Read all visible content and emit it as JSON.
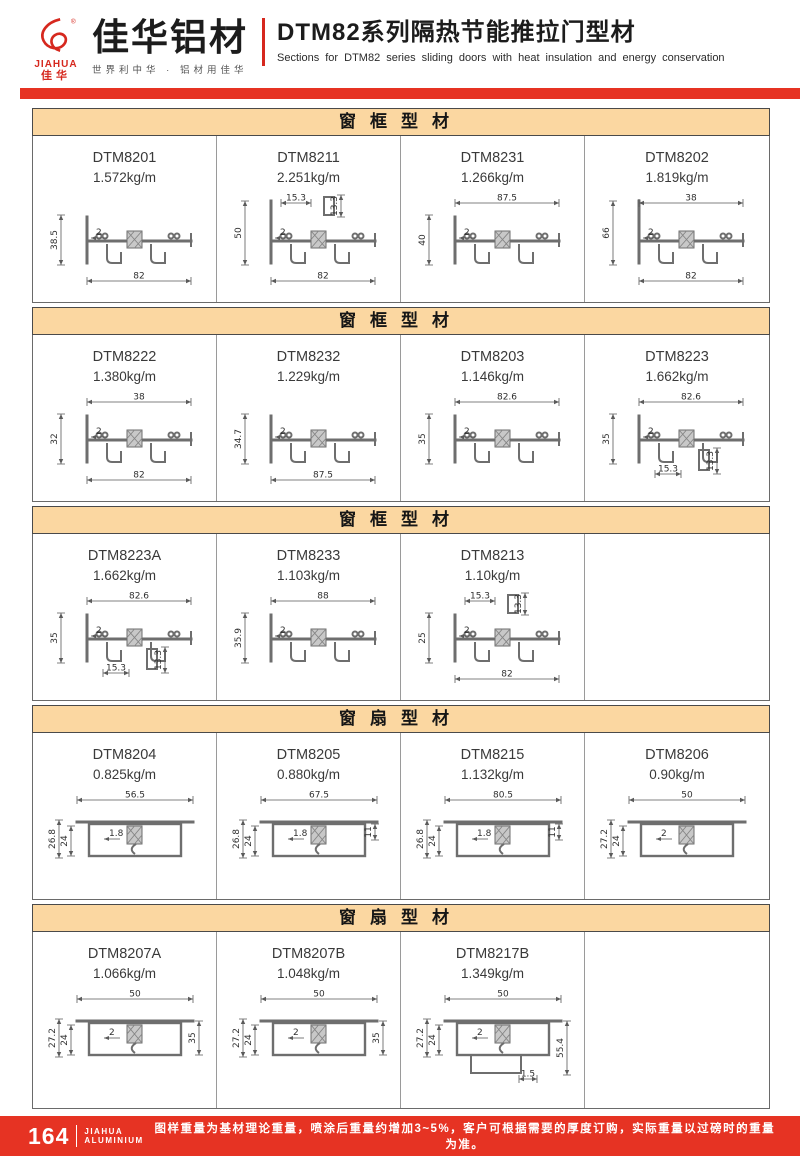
{
  "header": {
    "logo_en": "JIAHUA",
    "logo_cn": "佳华",
    "brand": "佳华铝材",
    "slogan": "世界利中华 · 铝材用佳华",
    "title_cn": "DTM82系列隔热节能推拉门型材",
    "title_en": "Sections for DTM82 series sliding doors with heat insulation and energy conservation"
  },
  "sections": [
    {
      "title": "窗框型材",
      "cells": [
        {
          "model": "DTM8201",
          "weight": "1.572kg/m",
          "variant": "frame",
          "dims": [
            {
              "label": "38.5",
              "kind": "left"
            },
            {
              "label": "2",
              "kind": "inner"
            },
            {
              "label": "82",
              "kind": "bottom"
            }
          ]
        },
        {
          "model": "DTM8211",
          "weight": "2.251kg/m",
          "variant": "frame",
          "tall": true,
          "dims": [
            {
              "label": "15.3",
              "kind": "topsmall"
            },
            {
              "label": "13.3",
              "kind": "vside"
            },
            {
              "label": "50",
              "kind": "left"
            },
            {
              "label": "2",
              "kind": "inner"
            },
            {
              "label": "82",
              "kind": "bottom"
            }
          ]
        },
        {
          "model": "DTM8231",
          "weight": "1.266kg/m",
          "variant": "frame",
          "dims": [
            {
              "label": "87.5",
              "kind": "top"
            },
            {
              "label": "40",
              "kind": "left"
            },
            {
              "label": "2",
              "kind": "inner"
            }
          ]
        },
        {
          "model": "DTM8202",
          "weight": "1.819kg/m",
          "variant": "frame",
          "tall": true,
          "dims": [
            {
              "label": "38",
              "kind": "top"
            },
            {
              "label": "66",
              "kind": "left"
            },
            {
              "label": "2",
              "kind": "inner"
            },
            {
              "label": "82",
              "kind": "bottom"
            }
          ]
        }
      ]
    },
    {
      "title": "窗框型材",
      "cells": [
        {
          "model": "DTM8222",
          "weight": "1.380kg/m",
          "variant": "frame",
          "dims": [
            {
              "label": "38",
              "kind": "top"
            },
            {
              "label": "32",
              "kind": "left"
            },
            {
              "label": "2",
              "kind": "inner"
            },
            {
              "label": "82",
              "kind": "bottom"
            }
          ]
        },
        {
          "model": "DTM8232",
          "weight": "1.229kg/m",
          "variant": "frame",
          "dims": [
            {
              "label": "34.7",
              "kind": "left"
            },
            {
              "label": "2",
              "kind": "inner"
            },
            {
              "label": "87.5",
              "kind": "bottom"
            }
          ]
        },
        {
          "model": "DTM8203",
          "weight": "1.146kg/m",
          "variant": "frame",
          "dims": [
            {
              "label": "82.6",
              "kind": "top"
            },
            {
              "label": "35",
              "kind": "left"
            },
            {
              "label": "2",
              "kind": "inner"
            }
          ]
        },
        {
          "model": "DTM8223",
          "weight": "1.662kg/m",
          "variant": "frame",
          "dims": [
            {
              "label": "82.6",
              "kind": "top"
            },
            {
              "label": "35",
              "kind": "left"
            },
            {
              "label": "2",
              "kind": "inner"
            },
            {
              "label": "15.3",
              "kind": "botsmall"
            },
            {
              "label": "13.3",
              "kind": "vsideb"
            }
          ]
        }
      ]
    },
    {
      "title": "窗框型材",
      "cells": [
        {
          "model": "DTM8223A",
          "weight": "1.662kg/m",
          "variant": "frame",
          "dims": [
            {
              "label": "82.6",
              "kind": "top"
            },
            {
              "label": "35",
              "kind": "left"
            },
            {
              "label": "2",
              "kind": "inner"
            },
            {
              "label": "15.3",
              "kind": "botsmall"
            },
            {
              "label": "13.3",
              "kind": "vsideb"
            }
          ]
        },
        {
          "model": "DTM8233",
          "weight": "1.103kg/m",
          "variant": "frame",
          "dims": [
            {
              "label": "88",
              "kind": "top"
            },
            {
              "label": "35.9",
              "kind": "left"
            },
            {
              "label": "2",
              "kind": "inner"
            }
          ]
        },
        {
          "model": "DTM8213",
          "weight": "1.10kg/m",
          "variant": "frame",
          "dims": [
            {
              "label": "15.3",
              "kind": "topsmall"
            },
            {
              "label": "13.3",
              "kind": "vside"
            },
            {
              "label": "25",
              "kind": "left"
            },
            {
              "label": "2",
              "kind": "inner"
            },
            {
              "label": "82",
              "kind": "bottom"
            }
          ]
        },
        null
      ]
    },
    {
      "title": "窗扇型材",
      "cells": [
        {
          "model": "DTM8204",
          "weight": "0.825kg/m",
          "variant": "sash",
          "dims": [
            {
              "label": "56.5",
              "kind": "top"
            },
            {
              "label": "26.8",
              "kind": "left"
            },
            {
              "label": "24",
              "kind": "left2"
            },
            {
              "label": "1.8",
              "kind": "inner"
            }
          ]
        },
        {
          "model": "DTM8205",
          "weight": "0.880kg/m",
          "variant": "sash",
          "dims": [
            {
              "label": "67.5",
              "kind": "top"
            },
            {
              "label": "26.8",
              "kind": "left"
            },
            {
              "label": "24",
              "kind": "left2"
            },
            {
              "label": "1.8",
              "kind": "inner"
            },
            {
              "label": "11",
              "kind": "rightsmall"
            }
          ]
        },
        {
          "model": "DTM8215",
          "weight": "1.132kg/m",
          "variant": "sash",
          "dims": [
            {
              "label": "80.5",
              "kind": "top"
            },
            {
              "label": "26.8",
              "kind": "left"
            },
            {
              "label": "24",
              "kind": "left2"
            },
            {
              "label": "1.8",
              "kind": "inner"
            },
            {
              "label": "11",
              "kind": "rightsmall"
            }
          ]
        },
        {
          "model": "DTM8206",
          "weight": "0.90kg/m",
          "variant": "sash",
          "dims": [
            {
              "label": "50",
              "kind": "top"
            },
            {
              "label": "27.2",
              "kind": "left"
            },
            {
              "label": "24",
              "kind": "left2"
            },
            {
              "label": "2",
              "kind": "inner"
            }
          ]
        }
      ]
    },
    {
      "title": "窗扇型材",
      "cells": [
        {
          "model": "DTM8207A",
          "weight": "1.066kg/m",
          "variant": "sash",
          "dims": [
            {
              "label": "50",
              "kind": "top"
            },
            {
              "label": "27.2",
              "kind": "left"
            },
            {
              "label": "24",
              "kind": "left2"
            },
            {
              "label": "2",
              "kind": "inner"
            },
            {
              "label": "35",
              "kind": "right"
            }
          ]
        },
        {
          "model": "DTM8207B",
          "weight": "1.048kg/m",
          "variant": "sash",
          "dims": [
            {
              "label": "50",
              "kind": "top"
            },
            {
              "label": "27.2",
              "kind": "left"
            },
            {
              "label": "24",
              "kind": "left2"
            },
            {
              "label": "2",
              "kind": "inner"
            },
            {
              "label": "35",
              "kind": "right"
            }
          ]
        },
        {
          "model": "DTM8217B",
          "weight": "1.349kg/m",
          "variant": "sash",
          "deep": true,
          "dims": [
            {
              "label": "50",
              "kind": "top"
            },
            {
              "label": "27.2",
              "kind": "left"
            },
            {
              "label": "24",
              "kind": "left2"
            },
            {
              "label": "2",
              "kind": "inner"
            },
            {
              "label": "55.4",
              "kind": "right"
            },
            {
              "label": "1.5",
              "kind": "botsmall"
            }
          ]
        },
        null
      ]
    }
  ],
  "footer": {
    "page_number": "164",
    "brand_top": "JIAHUA",
    "brand_bottom": "ALUMINIUM",
    "note": "图样重量为基材理论重量，喷涂后重量约增加3~5%，客户可根据需要的厚度订购，实际重量以过磅时的重量为准。"
  },
  "colors": {
    "accent_red": "#e63323",
    "logo_red": "#d6281e",
    "section_header_bg": "#fbd7a1",
    "border_dark": "#5a5a5a",
    "border_light": "#9a9a9a"
  }
}
